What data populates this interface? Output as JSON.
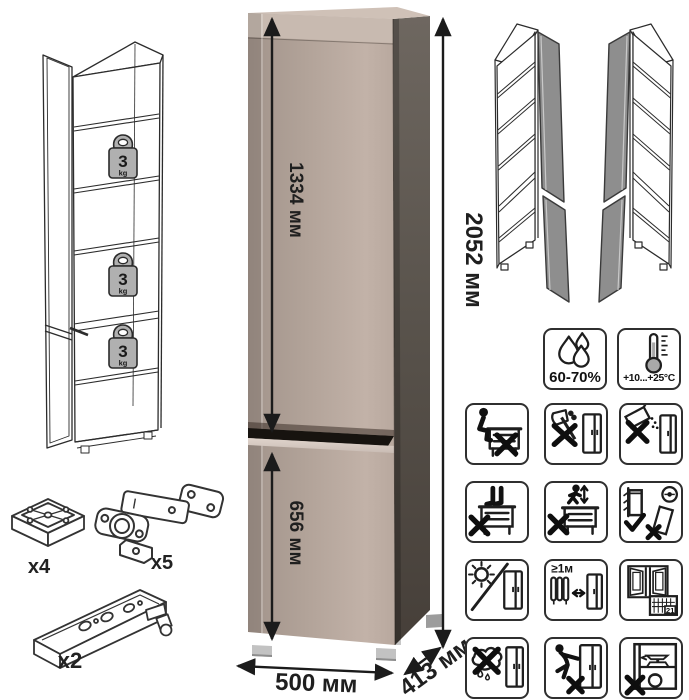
{
  "dimensions": {
    "upper_door_height": "1334 мм",
    "total_height": "2052 мм",
    "lower_door_height": "656 мм",
    "width": "500 мм",
    "depth": "413 мм"
  },
  "shelf_load": {
    "value": "3",
    "unit": "kg"
  },
  "hardware": {
    "foot": {
      "label": "x4"
    },
    "hinge": {
      "label": "x5"
    },
    "plinth": {
      "label": "x2"
    }
  },
  "climate": {
    "humidity": "60-70%",
    "temperature": "+10...+25°C"
  },
  "care": {
    "heat_distance": "≥1м",
    "calendar_day": "21",
    "icons": [
      "no-sitting-on-furniture",
      "no-sharp-tools",
      "no-abrasive-cleaners",
      "no-standing-on-furniture",
      "no-jumping-on-furniture",
      "anchor-to-wall",
      "avoid-direct-sunlight",
      "keep-1m-from-heaters",
      "ventilate-room",
      "no-wet-cloth",
      "no-dragging-furniture",
      "no-heavy-overload"
    ]
  },
  "colors": {
    "front": "#b2a399",
    "front_shade": "#a2948b",
    "front_light": "#c2b2a8",
    "side": "#58524b",
    "top": "#c9bbb1",
    "divider": "#17130f",
    "wireframe_door": "#8e8e8e"
  }
}
